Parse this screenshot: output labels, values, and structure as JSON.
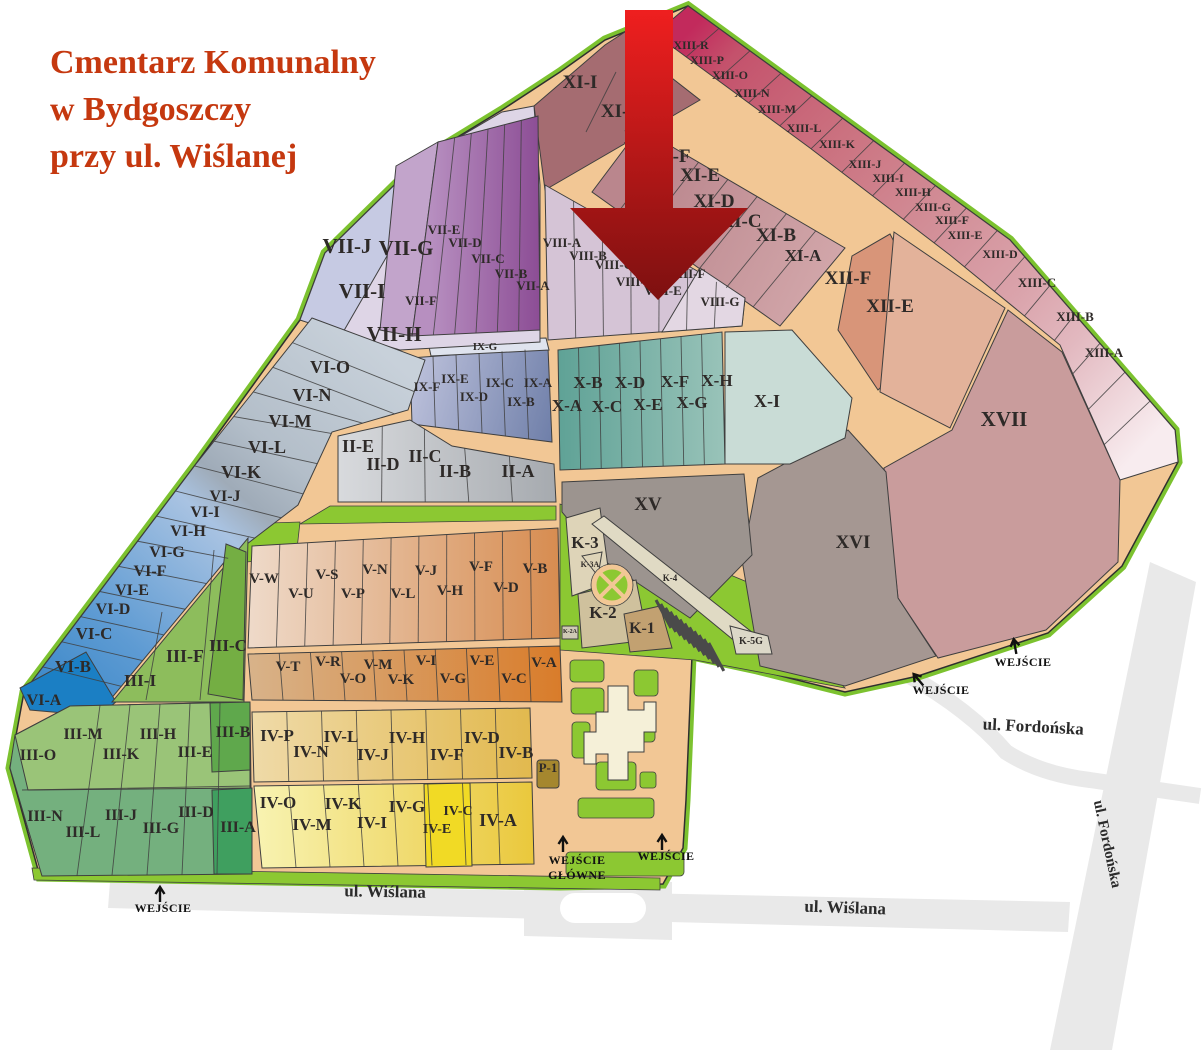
{
  "title": {
    "lines": [
      "Cmentarz Komunalny",
      "w Bydgoszczy",
      "przy ul. Wiślanej"
    ]
  },
  "map": {
    "sections": [
      {
        "id": "XIII-R",
        "x": 691,
        "y": 49,
        "s": 12
      },
      {
        "id": "XIII-P",
        "x": 707,
        "y": 64,
        "s": 12
      },
      {
        "id": "XIII-O",
        "x": 730,
        "y": 79,
        "s": 12
      },
      {
        "id": "XIII-N",
        "x": 752,
        "y": 97,
        "s": 12
      },
      {
        "id": "XIII-M",
        "x": 777,
        "y": 113,
        "s": 12
      },
      {
        "id": "XIII-L",
        "x": 804,
        "y": 132,
        "s": 12
      },
      {
        "id": "XIII-K",
        "x": 837,
        "y": 148,
        "s": 12
      },
      {
        "id": "XIII-J",
        "x": 865,
        "y": 168,
        "s": 12
      },
      {
        "id": "XIII-I",
        "x": 888,
        "y": 182,
        "s": 12
      },
      {
        "id": "XIII-H",
        "x": 913,
        "y": 196,
        "s": 12
      },
      {
        "id": "XIII-G",
        "x": 933,
        "y": 211,
        "s": 12
      },
      {
        "id": "XIII-F",
        "x": 952,
        "y": 224,
        "s": 12
      },
      {
        "id": "XIII-E",
        "x": 965,
        "y": 239,
        "s": 12
      },
      {
        "id": "XIII-D",
        "x": 1000,
        "y": 258,
        "s": 12
      },
      {
        "id": "XIII-C",
        "x": 1037,
        "y": 287,
        "s": 13
      },
      {
        "id": "XIII-B",
        "x": 1075,
        "y": 321,
        "s": 13
      },
      {
        "id": "XIII-A",
        "x": 1104,
        "y": 357,
        "s": 13
      },
      {
        "id": "XI-I",
        "x": 580,
        "y": 88,
        "s": 19
      },
      {
        "id": "XI-H",
        "x": 622,
        "y": 117,
        "s": 19
      },
      {
        "id": "XI-G",
        "x": 645,
        "y": 143,
        "s": 19
      },
      {
        "id": "XI-F",
        "x": 671,
        "y": 162,
        "s": 19
      },
      {
        "id": "XI-E",
        "x": 700,
        "y": 181,
        "s": 19
      },
      {
        "id": "XI-D",
        "x": 714,
        "y": 207,
        "s": 19
      },
      {
        "id": "XI-C",
        "x": 741,
        "y": 227,
        "s": 19
      },
      {
        "id": "XI-B",
        "x": 776,
        "y": 241,
        "s": 19
      },
      {
        "id": "XI-A",
        "x": 803,
        "y": 261,
        "s": 17
      },
      {
        "id": "XII-F",
        "x": 848,
        "y": 284,
        "s": 19
      },
      {
        "id": "XII-E",
        "x": 890,
        "y": 312,
        "s": 19
      },
      {
        "id": "XVII",
        "x": 1004,
        "y": 426,
        "s": 21
      },
      {
        "id": "XVI",
        "x": 853,
        "y": 548,
        "s": 19
      },
      {
        "id": "XV",
        "x": 648,
        "y": 510,
        "s": 19
      },
      {
        "id": "VII-J",
        "x": 347,
        "y": 253,
        "s": 21
      },
      {
        "id": "VII-G",
        "x": 406,
        "y": 255,
        "s": 21
      },
      {
        "id": "VII-I",
        "x": 362,
        "y": 298,
        "s": 21
      },
      {
        "id": "VII-H",
        "x": 394,
        "y": 341,
        "s": 21
      },
      {
        "id": "VII-F",
        "x": 421,
        "y": 305,
        "s": 13
      },
      {
        "id": "VII-E",
        "x": 444,
        "y": 234,
        "s": 13
      },
      {
        "id": "VII-D",
        "x": 465,
        "y": 247,
        "s": 13
      },
      {
        "id": "VII-C",
        "x": 488,
        "y": 263,
        "s": 13
      },
      {
        "id": "VII-B",
        "x": 511,
        "y": 278,
        "s": 13
      },
      {
        "id": "VII-A",
        "x": 533,
        "y": 290,
        "s": 13
      },
      {
        "id": "VIII-A",
        "x": 562,
        "y": 247,
        "s": 13
      },
      {
        "id": "VIII-B",
        "x": 588,
        "y": 260,
        "s": 13
      },
      {
        "id": "VIII-C",
        "x": 614,
        "y": 269,
        "s": 13
      },
      {
        "id": "VIII-D",
        "x": 635,
        "y": 286,
        "s": 13
      },
      {
        "id": "VIII-E",
        "x": 663,
        "y": 295,
        "s": 13
      },
      {
        "id": "VIII-F",
        "x": 687,
        "y": 278,
        "s": 13
      },
      {
        "id": "VIII-G",
        "x": 720,
        "y": 306,
        "s": 13
      },
      {
        "id": "IX-G",
        "x": 485,
        "y": 350,
        "s": 11
      },
      {
        "id": "IX-F",
        "x": 427,
        "y": 391,
        "s": 13
      },
      {
        "id": "IX-E",
        "x": 455,
        "y": 383,
        "s": 13
      },
      {
        "id": "IX-D",
        "x": 474,
        "y": 401,
        "s": 13
      },
      {
        "id": "IX-C",
        "x": 500,
        "y": 387,
        "s": 13
      },
      {
        "id": "IX-B",
        "x": 521,
        "y": 406,
        "s": 13
      },
      {
        "id": "IX-A",
        "x": 538,
        "y": 387,
        "s": 13
      },
      {
        "id": "X-A",
        "x": 567,
        "y": 411,
        "s": 17
      },
      {
        "id": "X-B",
        "x": 588,
        "y": 388,
        "s": 17
      },
      {
        "id": "X-C",
        "x": 607,
        "y": 412,
        "s": 17
      },
      {
        "id": "X-D",
        "x": 630,
        "y": 388,
        "s": 17
      },
      {
        "id": "X-E",
        "x": 648,
        "y": 410,
        "s": 17
      },
      {
        "id": "X-F",
        "x": 675,
        "y": 387,
        "s": 17
      },
      {
        "id": "X-G",
        "x": 692,
        "y": 408,
        "s": 17
      },
      {
        "id": "X-H",
        "x": 717,
        "y": 386,
        "s": 17
      },
      {
        "id": "X-I",
        "x": 767,
        "y": 407,
        "s": 18
      },
      {
        "id": "II-E",
        "x": 358,
        "y": 452,
        "s": 18
      },
      {
        "id": "II-D",
        "x": 383,
        "y": 470,
        "s": 18
      },
      {
        "id": "II-C",
        "x": 425,
        "y": 462,
        "s": 18
      },
      {
        "id": "II-B",
        "x": 455,
        "y": 477,
        "s": 18
      },
      {
        "id": "II-A",
        "x": 518,
        "y": 477,
        "s": 18
      },
      {
        "id": "VI-O",
        "x": 330,
        "y": 373,
        "s": 18
      },
      {
        "id": "VI-N",
        "x": 312,
        "y": 401,
        "s": 18
      },
      {
        "id": "VI-M",
        "x": 290,
        "y": 427,
        "s": 18
      },
      {
        "id": "VI-L",
        "x": 267,
        "y": 453,
        "s": 18
      },
      {
        "id": "VI-K",
        "x": 241,
        "y": 478,
        "s": 18
      },
      {
        "id": "VI-J",
        "x": 225,
        "y": 501,
        "s": 16
      },
      {
        "id": "VI-I",
        "x": 205,
        "y": 517,
        "s": 16
      },
      {
        "id": "VI-H",
        "x": 188,
        "y": 536,
        "s": 16
      },
      {
        "id": "VI-G",
        "x": 167,
        "y": 557,
        "s": 16
      },
      {
        "id": "VI-F",
        "x": 150,
        "y": 576,
        "s": 16
      },
      {
        "id": "VI-E",
        "x": 132,
        "y": 595,
        "s": 16
      },
      {
        "id": "VI-D",
        "x": 113,
        "y": 614,
        "s": 16
      },
      {
        "id": "VI-C",
        "x": 94,
        "y": 639,
        "s": 17
      },
      {
        "id": "VI-B",
        "x": 73,
        "y": 672,
        "s": 17
      },
      {
        "id": "VI-A",
        "x": 44,
        "y": 705,
        "s": 16
      },
      {
        "id": "III-F",
        "x": 185,
        "y": 662,
        "s": 18
      },
      {
        "id": "III-I",
        "x": 140,
        "y": 686,
        "s": 17
      },
      {
        "id": "III-C",
        "x": 228,
        "y": 651,
        "s": 17
      },
      {
        "id": "III-O",
        "x": 38,
        "y": 760,
        "s": 16
      },
      {
        "id": "III-M",
        "x": 83,
        "y": 739,
        "s": 16
      },
      {
        "id": "III-K",
        "x": 121,
        "y": 759,
        "s": 16
      },
      {
        "id": "III-H",
        "x": 158,
        "y": 739,
        "s": 16
      },
      {
        "id": "III-E",
        "x": 195,
        "y": 757,
        "s": 16
      },
      {
        "id": "III-B",
        "x": 233,
        "y": 737,
        "s": 16
      },
      {
        "id": "III-N",
        "x": 45,
        "y": 821,
        "s": 16
      },
      {
        "id": "III-L",
        "x": 83,
        "y": 837,
        "s": 16
      },
      {
        "id": "III-J",
        "x": 121,
        "y": 820,
        "s": 16
      },
      {
        "id": "III-G",
        "x": 161,
        "y": 833,
        "s": 16
      },
      {
        "id": "III-D",
        "x": 196,
        "y": 817,
        "s": 16
      },
      {
        "id": "III-A",
        "x": 238,
        "y": 832,
        "s": 16
      },
      {
        "id": "V-W",
        "x": 264,
        "y": 583,
        "s": 15
      },
      {
        "id": "V-U",
        "x": 301,
        "y": 598,
        "s": 15
      },
      {
        "id": "V-S",
        "x": 327,
        "y": 579,
        "s": 15
      },
      {
        "id": "V-P",
        "x": 353,
        "y": 598,
        "s": 15
      },
      {
        "id": "V-N",
        "x": 375,
        "y": 574,
        "s": 15
      },
      {
        "id": "V-L",
        "x": 403,
        "y": 598,
        "s": 15
      },
      {
        "id": "V-J",
        "x": 426,
        "y": 575,
        "s": 15
      },
      {
        "id": "V-H",
        "x": 450,
        "y": 595,
        "s": 15
      },
      {
        "id": "V-F",
        "x": 481,
        "y": 571,
        "s": 15
      },
      {
        "id": "V-D",
        "x": 506,
        "y": 592,
        "s": 15
      },
      {
        "id": "V-B",
        "x": 535,
        "y": 573,
        "s": 15
      },
      {
        "id": "V-T",
        "x": 288,
        "y": 671,
        "s": 15
      },
      {
        "id": "V-R",
        "x": 328,
        "y": 666,
        "s": 15
      },
      {
        "id": "V-O",
        "x": 353,
        "y": 683,
        "s": 15
      },
      {
        "id": "V-M",
        "x": 378,
        "y": 669,
        "s": 15
      },
      {
        "id": "V-K",
        "x": 401,
        "y": 684,
        "s": 15
      },
      {
        "id": "V-I",
        "x": 426,
        "y": 665,
        "s": 15
      },
      {
        "id": "V-G",
        "x": 453,
        "y": 683,
        "s": 15
      },
      {
        "id": "V-E",
        "x": 482,
        "y": 665,
        "s": 15
      },
      {
        "id": "V-C",
        "x": 514,
        "y": 683,
        "s": 15
      },
      {
        "id": "V-A",
        "x": 544,
        "y": 667,
        "s": 15
      },
      {
        "id": "IV-P",
        "x": 277,
        "y": 741,
        "s": 17
      },
      {
        "id": "IV-N",
        "x": 311,
        "y": 757,
        "s": 17
      },
      {
        "id": "IV-L",
        "x": 341,
        "y": 742,
        "s": 17
      },
      {
        "id": "IV-J",
        "x": 373,
        "y": 760,
        "s": 17
      },
      {
        "id": "IV-H",
        "x": 407,
        "y": 743,
        "s": 17
      },
      {
        "id": "IV-F",
        "x": 447,
        "y": 760,
        "s": 17
      },
      {
        "id": "IV-D",
        "x": 482,
        "y": 743,
        "s": 17
      },
      {
        "id": "IV-B",
        "x": 516,
        "y": 758,
        "s": 17
      },
      {
        "id": "IV-O",
        "x": 278,
        "y": 808,
        "s": 17
      },
      {
        "id": "IV-M",
        "x": 312,
        "y": 830,
        "s": 17
      },
      {
        "id": "IV-K",
        "x": 343,
        "y": 809,
        "s": 17
      },
      {
        "id": "IV-I",
        "x": 372,
        "y": 828,
        "s": 17
      },
      {
        "id": "IV-G",
        "x": 407,
        "y": 812,
        "s": 17
      },
      {
        "id": "IV-E",
        "x": 437,
        "y": 833,
        "s": 14
      },
      {
        "id": "IV-C",
        "x": 458,
        "y": 815,
        "s": 14
      },
      {
        "id": "IV-A",
        "x": 498,
        "y": 826,
        "s": 18
      },
      {
        "id": "K-3",
        "x": 585,
        "y": 548,
        "s": 17
      },
      {
        "id": "K-3A",
        "x": 590,
        "y": 567,
        "s": 8
      },
      {
        "id": "K-2",
        "x": 603,
        "y": 618,
        "s": 17
      },
      {
        "id": "K-1",
        "x": 642,
        "y": 633,
        "s": 16
      },
      {
        "id": "K-4",
        "x": 670,
        "y": 581,
        "s": 9
      },
      {
        "id": "K-5G",
        "x": 751,
        "y": 644,
        "s": 10
      },
      {
        "id": "K-2A",
        "x": 570,
        "y": 633,
        "s": 6
      },
      {
        "id": "P-1",
        "x": 548,
        "y": 772,
        "s": 13
      }
    ],
    "streets": [
      {
        "label": "ul. Wiślana",
        "x": 385,
        "y": 897,
        "rot": 1,
        "s": 17
      },
      {
        "label": "ul. Wiślana",
        "x": 845,
        "y": 913,
        "rot": 2,
        "s": 17
      },
      {
        "label": "ul. Fordońska",
        "x": 1033,
        "y": 732,
        "rot": 3,
        "s": 17
      },
      {
        "label": "ul. Fordońska",
        "x": 1103,
        "y": 845,
        "rot": 78,
        "s": 15
      }
    ],
    "entrances": [
      {
        "lines": [
          "WEJŚCIE"
        ],
        "x": 163,
        "y": 912,
        "ax": 160,
        "ay": 900,
        "rot": 0
      },
      {
        "lines": [
          "WEJŚCIE",
          "GŁÓWNE"
        ],
        "x": 577,
        "y": 864,
        "ax": 563,
        "ay": 850,
        "rot": 0
      },
      {
        "lines": [
          "WEJŚCIE"
        ],
        "x": 666,
        "y": 860,
        "ax": 662,
        "ay": 848,
        "rot": 0
      },
      {
        "lines": [
          "WEJŚCIE"
        ],
        "x": 941,
        "y": 694,
        "ax": 922,
        "ay": 684,
        "rot": -40
      },
      {
        "lines": [
          "WEJŚCIE"
        ],
        "x": 1023,
        "y": 666,
        "ax": 1016,
        "ay": 652,
        "rot": -10
      }
    ]
  },
  "palette": {
    "road": "#f2c795",
    "outline": "#2f2f2f",
    "rim": "#7cc22f",
    "green": "#8cc832",
    "xi_block": "#a56c71",
    "xii_f": "#d89579",
    "xii_e": "#e3b29a",
    "xvii": "#c99c9c",
    "xvi": "#a59792",
    "xv": "#9c948f",
    "xi_teal": "#c9dcd6",
    "ixg": "#dfe3ee",
    "viii": "#d5c4d6",
    "viiig": "#e3d7e3",
    "vii_base": "#ded5e6",
    "vii_j": "#c6cae3",
    "vii_g": "#c2a4cb",
    "vi_a": "#1b7fc4",
    "iii_wedge": "#8dbd5c",
    "iii_c": "#74ae43",
    "iii_grid": "#74b07e",
    "iii_top": "#9ac478",
    "iii_b": "#5fa84c",
    "iii_a": "#3f9f5f",
    "iv_ec": "#f1da25",
    "k3": "#ded4b8",
    "k2": "#cfc19d",
    "k1": "#c2a171",
    "k4": "#e0dac4",
    "k5g": "#dcd8c8",
    "k2a": "#cfc9b5",
    "p1": "#a5872e",
    "chapel": "#f5f0d8",
    "street": "#e9e9e9",
    "label": "#2e2a28",
    "title": "#c5380f",
    "hatch": "#4a4a4a",
    "entrance_text": "#111111"
  },
  "gradients": {
    "gXIII": [
      [
        0,
        "#c22a5c"
      ],
      [
        0.08,
        "#c4526c"
      ],
      [
        0.3,
        "#cb7280"
      ],
      [
        0.5,
        "#d28e97"
      ],
      [
        0.68,
        "#daa3ab"
      ],
      [
        0.8,
        "#e2b8bf"
      ],
      [
        0.9,
        "#edd2d7"
      ],
      [
        1,
        "#f8ecef"
      ]
    ],
    "gXI": [
      [
        0,
        "#ba868d"
      ],
      [
        1,
        "#d4a9ac"
      ]
    ],
    "gVII": [
      [
        0,
        "#b78fc0"
      ],
      [
        1,
        "#8a4a93"
      ]
    ],
    "gX": [
      [
        0,
        "#5fa296"
      ],
      [
        1,
        "#99c3b9"
      ]
    ],
    "gIX": [
      [
        0,
        "#b9bed9"
      ],
      [
        1,
        "#6f7fa9"
      ]
    ],
    "gII": [
      [
        0,
        "#d8dadd"
      ],
      [
        1,
        "#a6aaaf"
      ]
    ],
    "gVI": [
      [
        0,
        "#c8d1da"
      ],
      [
        0.3,
        "#b3bec9"
      ],
      [
        0.42,
        "#9fabb8"
      ],
      [
        0.5,
        "#a9c3e2"
      ],
      [
        0.8,
        "#5e9bd3"
      ],
      [
        1,
        "#3d89c9"
      ]
    ],
    "gVtop": [
      [
        0,
        "#eed9c8"
      ],
      [
        1,
        "#d78c50"
      ]
    ],
    "gVbot": [
      [
        0,
        "#d8b38a"
      ],
      [
        1,
        "#d97c2a"
      ]
    ],
    "gIVtop": [
      [
        0,
        "#efdaa8"
      ],
      [
        1,
        "#e2b94e"
      ]
    ],
    "gIVbot": [
      [
        0,
        "#f8f3b2"
      ],
      [
        1,
        "#eac83c"
      ]
    ],
    "gArrow": [
      [
        0,
        "#ef1f1f"
      ],
      [
        1,
        "#7d1010"
      ]
    ]
  }
}
